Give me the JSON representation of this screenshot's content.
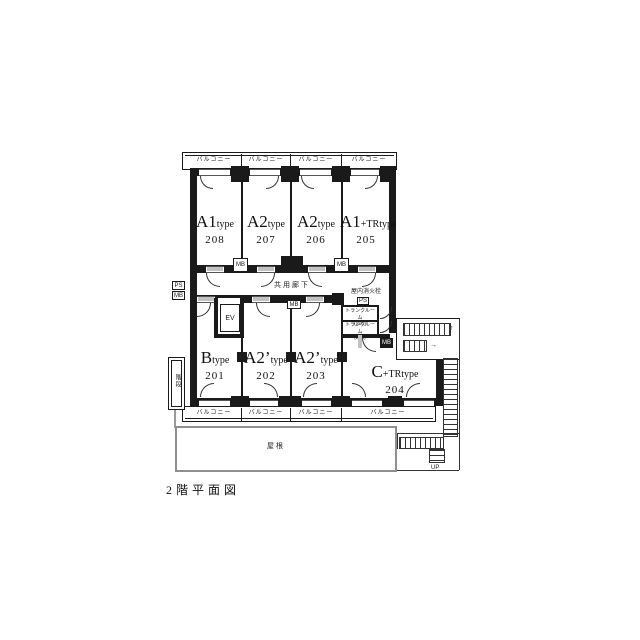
{
  "caption": "2階平面図",
  "labels": {
    "balcony": "バルコニー",
    "corridor": "共用廊下",
    "roof": "屋根",
    "side_stair": "階段",
    "elevator": "EV",
    "fire_hydrant": "屋内消火栓",
    "mb": "MB",
    "ps": "PS",
    "up": "UP",
    "up_arrow": "↑",
    "right_arrow": "→"
  },
  "trunk_rooms": [
    {
      "line1": "トランクルーム",
      "line2": "(205)"
    },
    {
      "line1": "トランクルーム",
      "line2": "(204)"
    }
  ],
  "rooms_top": [
    {
      "big": "A1",
      "small": "type",
      "num": "208"
    },
    {
      "big": "A2",
      "small": "type",
      "num": "207"
    },
    {
      "big": "A2",
      "small": "type",
      "num": "206"
    },
    {
      "big": "A1",
      "small": "+TRtype",
      "num": "205"
    }
  ],
  "rooms_bottom": [
    {
      "big": "B",
      "small": "type",
      "num": "201"
    },
    {
      "big": "A2’",
      "small": "type",
      "num": "202"
    },
    {
      "big": "A2’",
      "small": "type",
      "num": "203"
    },
    {
      "big": "C",
      "small": "+TRtype",
      "num": "204"
    }
  ]
}
